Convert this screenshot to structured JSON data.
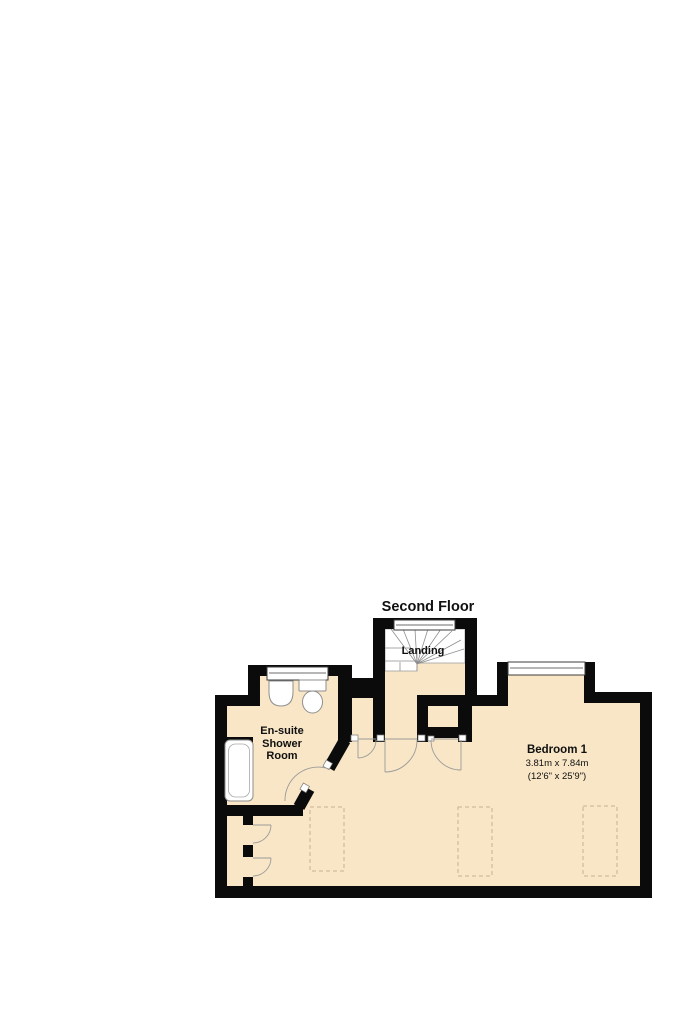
{
  "title": "Second Floor",
  "rooms": {
    "landing": {
      "label": "Landing"
    },
    "ensuite": {
      "line1": "En-suite",
      "line2": "Shower",
      "line3": "Room"
    },
    "bedroom": {
      "label": "Bedroom 1",
      "size_metric": "3.81m x 7.84m",
      "size_imperial": "(12'6\" x 25'9\")"
    }
  },
  "colors": {
    "background": "#ffffff",
    "wall": "#0b0b0b",
    "floor": "#f8e6c6",
    "fixture_outline": "#8f8f8f",
    "dashed_outline": "#c7b393"
  }
}
